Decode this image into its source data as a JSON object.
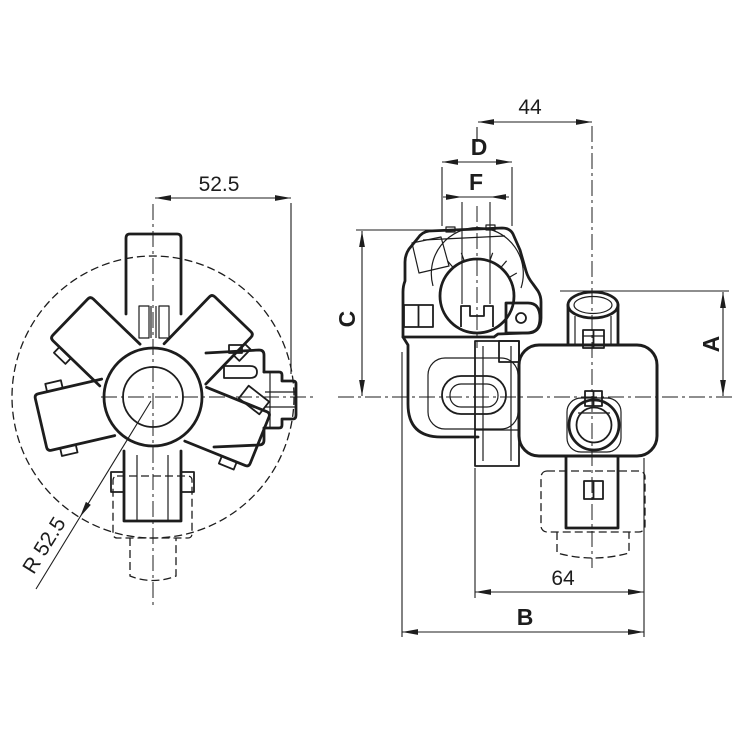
{
  "drawing": {
    "background": "#ffffff",
    "line_color": "#1d1d1d",
    "views": {
      "front": "front-view",
      "side": "side-view"
    },
    "dimensions": {
      "front_width": "52.5",
      "front_radius": "R 52.5",
      "port_offset": "44",
      "clamp_dia": "D",
      "slot_width": "F",
      "height_c": "C",
      "height_a": "A",
      "base_inner": "64",
      "base_overall": "B"
    }
  }
}
